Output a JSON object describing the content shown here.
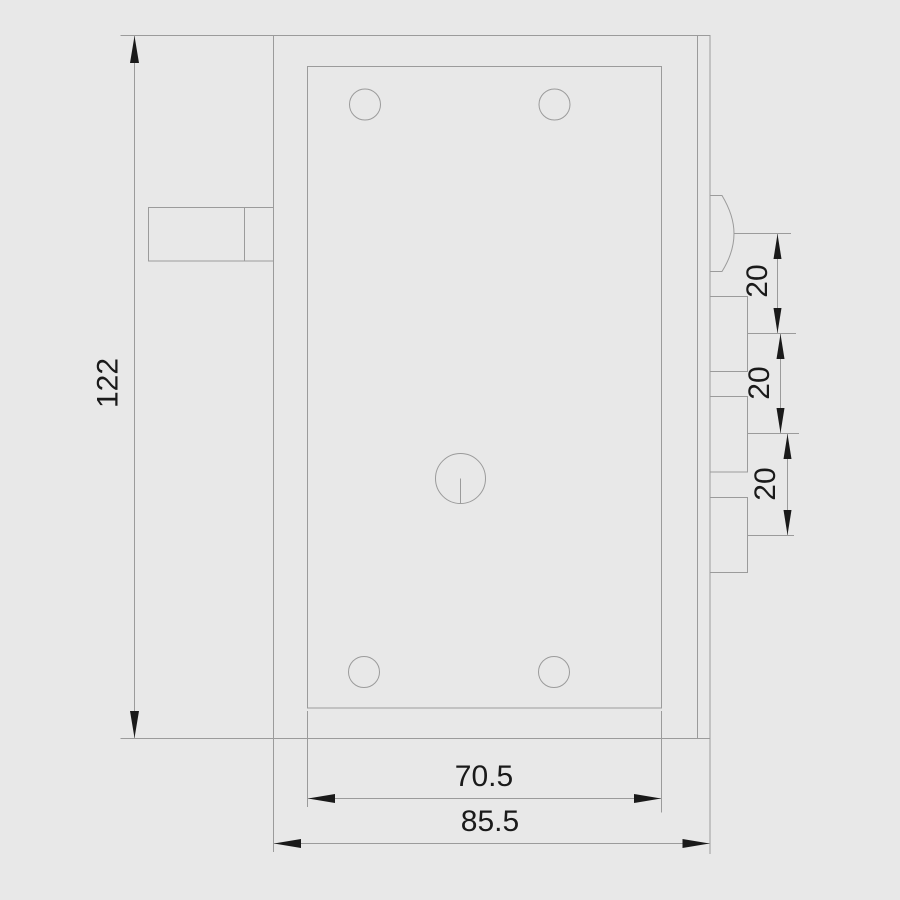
{
  "drawing": {
    "type": "technical-drawing",
    "subject": "lock-case-front-view",
    "background_color": "#e8e8e8",
    "line_color": "#9b9b9b",
    "text_color": "#1a1a1a",
    "dimensions": {
      "overall_height": "122",
      "inner_plate_width": "70.5",
      "overall_width": "85.5",
      "spacing": [
        "20",
        "20",
        "20"
      ]
    }
  }
}
